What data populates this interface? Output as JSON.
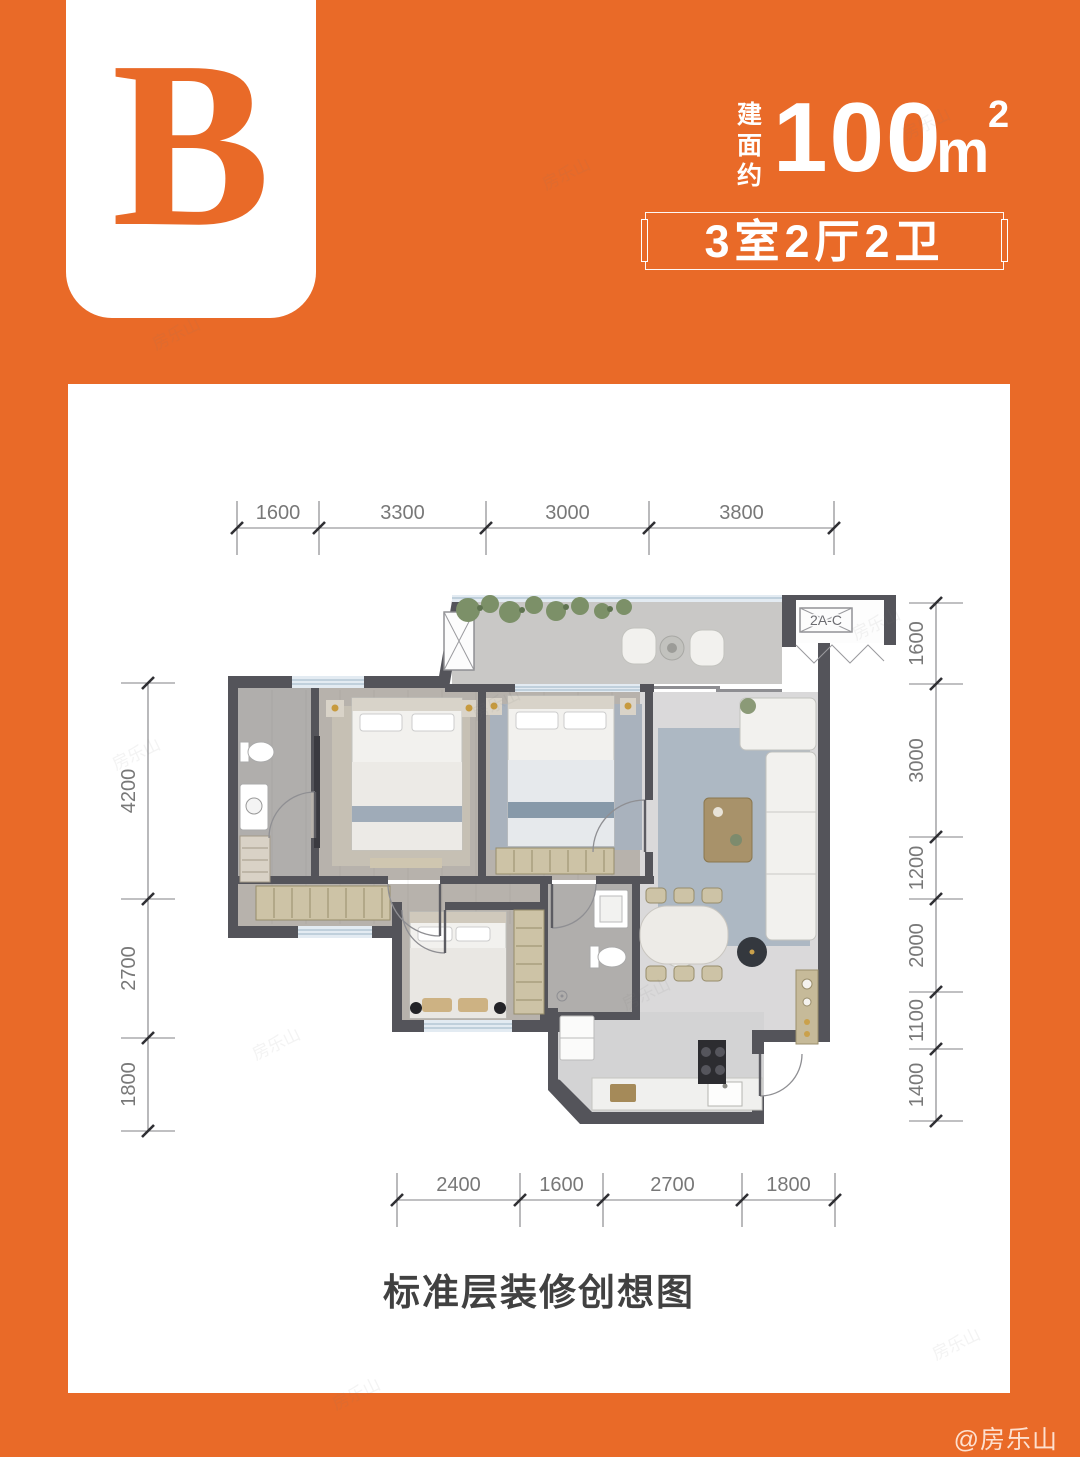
{
  "badge": {
    "letter": "B"
  },
  "area": {
    "prefix_vertical": "建面约",
    "value": "100",
    "unit": "m",
    "superscript": "2"
  },
  "spec_box": {
    "text": "3室2厅2卫"
  },
  "caption": {
    "text": "标准层装修创想图"
  },
  "credit": {
    "text": "@房乐山"
  },
  "faint_watermark": {
    "text": "房乐山"
  },
  "plan": {
    "ac_platform_label": "2A-C",
    "dimensions": {
      "top": {
        "orient": "h",
        "line": 528,
        "ticks": [
          237,
          319,
          486,
          649,
          834
        ],
        "labels": [
          "1600",
          "3300",
          "3000",
          "3800"
        ]
      },
      "bottom": {
        "orient": "h",
        "line": 1200,
        "ticks": [
          397,
          520,
          603,
          742,
          835
        ],
        "labels": [
          "2400",
          "1600",
          "2700",
          "1800"
        ]
      },
      "left": {
        "orient": "v",
        "line": 148,
        "ticks": [
          683,
          899,
          1038,
          1131
        ],
        "labels": [
          "4200",
          "2700",
          "1800"
        ]
      },
      "right": {
        "orient": "v",
        "line": 936,
        "ticks": [
          603,
          684,
          837,
          899,
          992,
          1049,
          1121
        ],
        "labels": [
          "1600",
          "3000",
          "1200",
          "2000",
          "1100",
          "1400"
        ]
      }
    }
  },
  "colors": {
    "brand_orange": "#E96A28",
    "wall": "#54545A",
    "dim_line": "#808084",
    "dim_text": "#787878",
    "caption_text": "#414141"
  }
}
